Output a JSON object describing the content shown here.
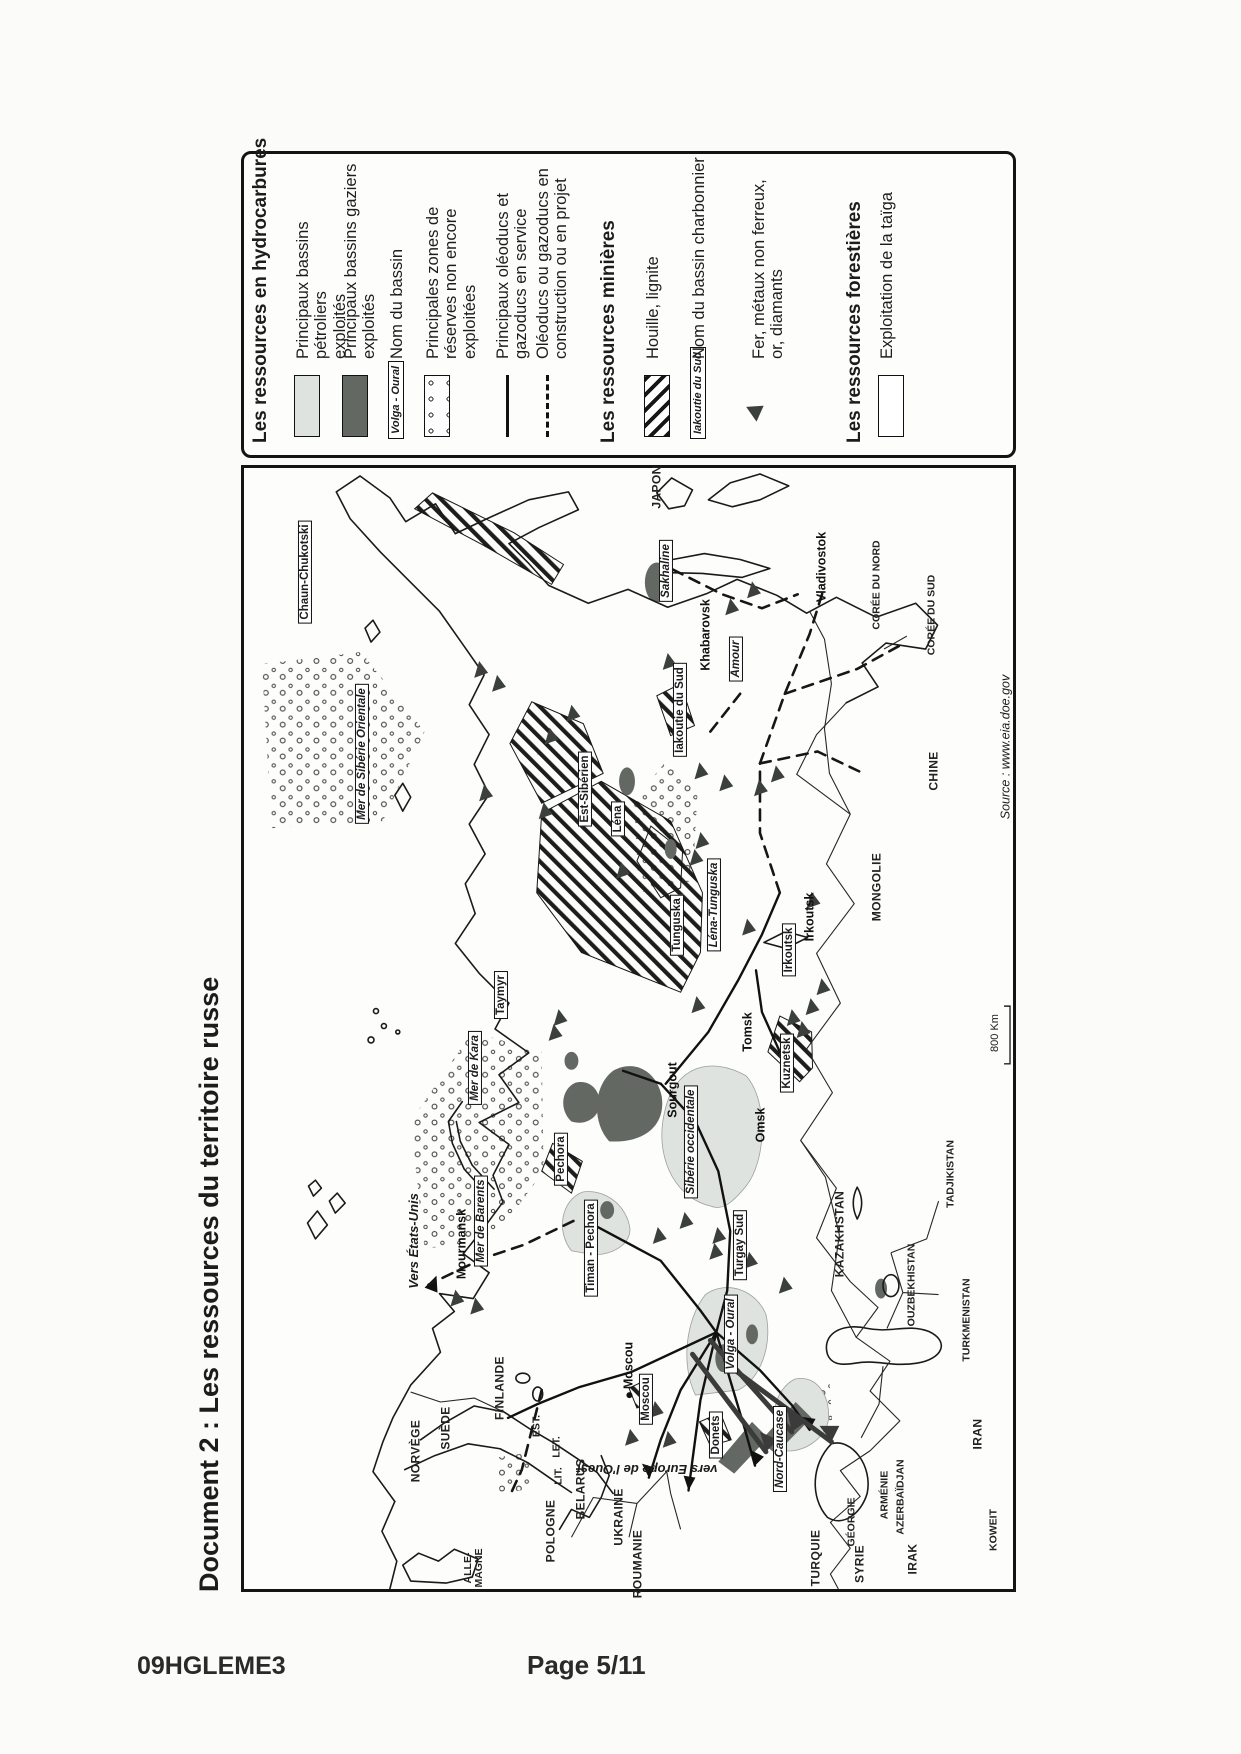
{
  "page": {
    "vertical_title": "Document 2 : Les ressources du territoire russe",
    "footer_left": "09HGLEME3",
    "footer_right": "Page 5/11"
  },
  "colors": {
    "ink": "#1c1c1c",
    "paper": "#fbfbf9",
    "light_basin": "#dfe3df",
    "dark_basin": "#636863"
  },
  "legend": {
    "items": [
      {
        "kind": "header",
        "text": "Les ressources en hydrocarbures",
        "y": 6
      },
      {
        "kind": "light",
        "text": "Principaux bassins pétroliers\nexploités",
        "y": 50
      },
      {
        "kind": "dark",
        "text": "Principaux bassins gaziers\nexploités",
        "y": 98
      },
      {
        "kind": "namebox",
        "name": "Volga - Oural",
        "text": "Nom du bassin",
        "y": 144
      },
      {
        "kind": "dots",
        "text": "Principales zones de\nréserves non encore\nexploitées",
        "y": 180
      },
      {
        "kind": "solid",
        "text": "Principaux oléoducs et\ngazoducs en service",
        "y": 250
      },
      {
        "kind": "dashed",
        "text": "Oléoducs ou gazoducs en\nconstruction ou en projet",
        "y": 290
      },
      {
        "kind": "header",
        "text": "Les ressources minières",
        "y": 354
      },
      {
        "kind": "hatch",
        "text": "Houille, lignite",
        "y": 400
      },
      {
        "kind": "namebox",
        "name": "Iakoutie du Sud",
        "text": "Nom du bassin charbonnier",
        "y": 446
      },
      {
        "kind": "triangle",
        "text": "Fer, métaux non ferreux,\nor, diamants",
        "y": 506
      },
      {
        "kind": "header",
        "text": "Les ressources forestières",
        "y": 600
      },
      {
        "kind": "white",
        "text": "Exploitation de la taïga",
        "y": 634
      }
    ]
  },
  "map": {
    "source": "Source : www.eia.doe.gov",
    "scale_label": "800 Km",
    "labels": [
      {
        "t": "JAPON",
        "x": 1102,
        "y": 413,
        "s": "country"
      },
      {
        "t": "Sakhaline",
        "x": 1018,
        "y": 422,
        "s": "boxi"
      },
      {
        "t": "Vladivostok",
        "x": 1022,
        "y": 578,
        "s": "city"
      },
      {
        "t": "CORÉE DU NORD",
        "x": 1004,
        "y": 633,
        "s": "smallcountry"
      },
      {
        "t": "CORÉE DU SUD",
        "x": 974,
        "y": 688,
        "s": "smallcountry"
      },
      {
        "t": "Khabarovsk",
        "x": 954,
        "y": 462,
        "s": "city"
      },
      {
        "t": "Amour",
        "x": 930,
        "y": 492,
        "s": "boxi"
      },
      {
        "t": "Iakoutie du Sud",
        "x": 879,
        "y": 436,
        "s": "box"
      },
      {
        "t": "CHINE",
        "x": 818,
        "y": 690,
        "s": "country"
      },
      {
        "t": "MONGOLIE",
        "x": 702,
        "y": 633,
        "s": "country"
      },
      {
        "t": "Chaun-Chukotski",
        "x": 1017,
        "y": 61,
        "s": "box"
      },
      {
        "t": "Mer de Sibérie Orientale",
        "x": 835,
        "y": 118,
        "s": "boxi"
      },
      {
        "t": "Est-Sibérien",
        "x": 800,
        "y": 341,
        "s": "box"
      },
      {
        "t": "Léna",
        "x": 770,
        "y": 374,
        "s": "box"
      },
      {
        "t": "Tunguska",
        "x": 664,
        "y": 433,
        "s": "box"
      },
      {
        "t": "Léna-Tunguska",
        "x": 684,
        "y": 470,
        "s": "boxi"
      },
      {
        "t": "Irkoutsk",
        "x": 639,
        "y": 545,
        "s": "box"
      },
      {
        "t": "Irkoutsk",
        "x": 672,
        "y": 566,
        "s": "city"
      },
      {
        "t": "Taymyr",
        "x": 594,
        "y": 257,
        "s": "box"
      },
      {
        "t": "Mer de Kara",
        "x": 521,
        "y": 231,
        "s": "boxi"
      },
      {
        "t": "Tomsk",
        "x": 557,
        "y": 504,
        "s": "city"
      },
      {
        "t": "Kuznetsk",
        "x": 526,
        "y": 543,
        "s": "box"
      },
      {
        "t": "Sourgout",
        "x": 499,
        "y": 429,
        "s": "city"
      },
      {
        "t": "Sibérie occidentale",
        "x": 447,
        "y": 447,
        "s": "boxi"
      },
      {
        "t": "Omsk",
        "x": 464,
        "y": 517,
        "s": "city"
      },
      {
        "t": "TADJIKISTAN",
        "x": 415,
        "y": 707,
        "s": "smallcountry"
      },
      {
        "t": "KAZAKHSTAN",
        "x": 355,
        "y": 596,
        "s": "country"
      },
      {
        "t": "Pechora",
        "x": 430,
        "y": 317,
        "s": "box"
      },
      {
        "t": "Mer de Barents",
        "x": 368,
        "y": 237,
        "s": "boxi"
      },
      {
        "t": "Mourmansk",
        "x": 345,
        "y": 218,
        "s": "city"
      },
      {
        "t": "Vers États-Unis",
        "x": 348,
        "y": 170,
        "s": "ital"
      },
      {
        "t": "Timan - Pechora",
        "x": 341,
        "y": 347,
        "s": "box"
      },
      {
        "t": "Turgay Sud",
        "x": 344,
        "y": 496,
        "s": "box"
      },
      {
        "t": "Volga - Oural",
        "x": 255,
        "y": 487,
        "s": "boxi"
      },
      {
        "t": "OUZBEKHISTAN",
        "x": 304,
        "y": 668,
        "s": "smallcountry"
      },
      {
        "t": "TURKMENISTAN",
        "x": 269,
        "y": 723,
        "s": "smallcountry"
      },
      {
        "t": "Moscou",
        "x": 219,
        "y": 385,
        "s": "city citydot"
      },
      {
        "t": "Moscou",
        "x": 190,
        "y": 402,
        "s": "box"
      },
      {
        "t": "Donets",
        "x": 154,
        "y": 472,
        "s": "box"
      },
      {
        "t": "Nord-Caucase",
        "x": 140,
        "y": 536,
        "s": "boxi"
      },
      {
        "t": "vers Europe de l'Ouest",
        "x": 120,
        "y": 403,
        "s": "ital rot90"
      },
      {
        "t": "UKRAINE",
        "x": 72,
        "y": 375,
        "s": "country"
      },
      {
        "t": "ROUMANIE",
        "x": 25,
        "y": 394,
        "s": "country"
      },
      {
        "t": "GÉORGIE",
        "x": 67,
        "y": 608,
        "s": "smallcountry"
      },
      {
        "t": "ARMÉNIE",
        "x": 94,
        "y": 641,
        "s": "smallcountry"
      },
      {
        "t": "AZERBAÏDJAN",
        "x": 92,
        "y": 657,
        "s": "smallcountry"
      },
      {
        "t": "IRAN",
        "x": 155,
        "y": 734,
        "s": "country"
      },
      {
        "t": "KOWEIT",
        "x": 59,
        "y": 750,
        "s": "smallcountry"
      },
      {
        "t": "IRAK",
        "x": 30,
        "y": 669,
        "s": "country"
      },
      {
        "t": "SYRIE",
        "x": 25,
        "y": 616,
        "s": "country"
      },
      {
        "t": "TURQUIE",
        "x": 31,
        "y": 572,
        "s": "country"
      },
      {
        "t": "FINLANDE",
        "x": 201,
        "y": 256,
        "s": "country"
      },
      {
        "t": "SUÈDE",
        "x": 161,
        "y": 202,
        "s": "country"
      },
      {
        "t": "NORVÈGE",
        "x": 138,
        "y": 172,
        "s": "country"
      },
      {
        "t": "EST.",
        "x": 163,
        "y": 293,
        "s": "smallcountry"
      },
      {
        "t": "LET.",
        "x": 142,
        "y": 313,
        "s": "smallcountry"
      },
      {
        "t": "LIT.",
        "x": 113,
        "y": 315,
        "s": "smallcountry"
      },
      {
        "t": "BELARUS",
        "x": 100,
        "y": 337,
        "s": "country"
      },
      {
        "t": "POLOGNE",
        "x": 58,
        "y": 307,
        "s": "country"
      },
      {
        "t": "ALLE-\nMAGNE",
        "x": 21,
        "y": 230,
        "s": "smallcountry"
      }
    ],
    "triangles": [
      [
        1004,
        512
      ],
      [
        987,
        490
      ],
      [
        932,
        427
      ],
      [
        822,
        459
      ],
      [
        810,
        484
      ],
      [
        805,
        519
      ],
      [
        819,
        536
      ],
      [
        752,
        460
      ],
      [
        735,
        454
      ],
      [
        924,
        237
      ],
      [
        910,
        255
      ],
      [
        880,
        330
      ],
      [
        857,
        308
      ],
      [
        800,
        242
      ],
      [
        782,
        302
      ],
      [
        722,
        380
      ],
      [
        692,
        572
      ],
      [
        665,
        507
      ],
      [
        587,
        456
      ],
      [
        605,
        582
      ],
      [
        585,
        571
      ],
      [
        574,
        552
      ],
      [
        562,
        562
      ],
      [
        370,
        444
      ],
      [
        355,
        417
      ],
      [
        355,
        477
      ],
      [
        574,
        317
      ],
      [
        559,
        312
      ],
      [
        292,
        213
      ],
      [
        284,
        233
      ],
      [
        180,
        414
      ],
      [
        152,
        389
      ],
      [
        150,
        427
      ],
      [
        330,
        509
      ],
      [
        305,
        544
      ],
      [
        339,
        474
      ]
    ]
  }
}
